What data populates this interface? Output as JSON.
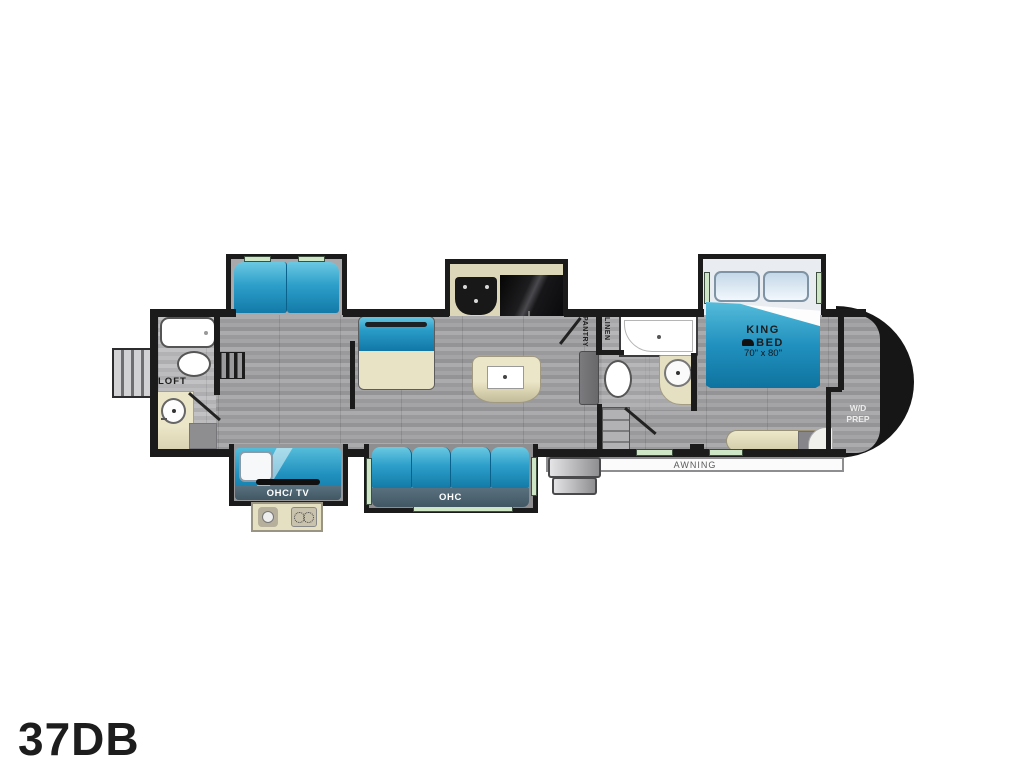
{
  "model_label": "37DB",
  "floorplan": {
    "labels": {
      "loft": "LOFT",
      "pantry": "PANTRY",
      "linen": "LINEN",
      "king_line1": "KING",
      "king_line2": "BED",
      "king_size": "70\" x 80\"",
      "wd_line1": "W/D",
      "wd_line2": "PREP",
      "ohc_tv": "OHC/ TV",
      "ohc": "OHC",
      "awning": "AWNING"
    },
    "colors": {
      "furniture_blue": "#1d94c1",
      "cabinet_tan": "#e8e2c4",
      "wall_black": "#1b1b1b",
      "floor_gray": "#9e9ea0",
      "window_green": "#cfe6c6"
    }
  }
}
